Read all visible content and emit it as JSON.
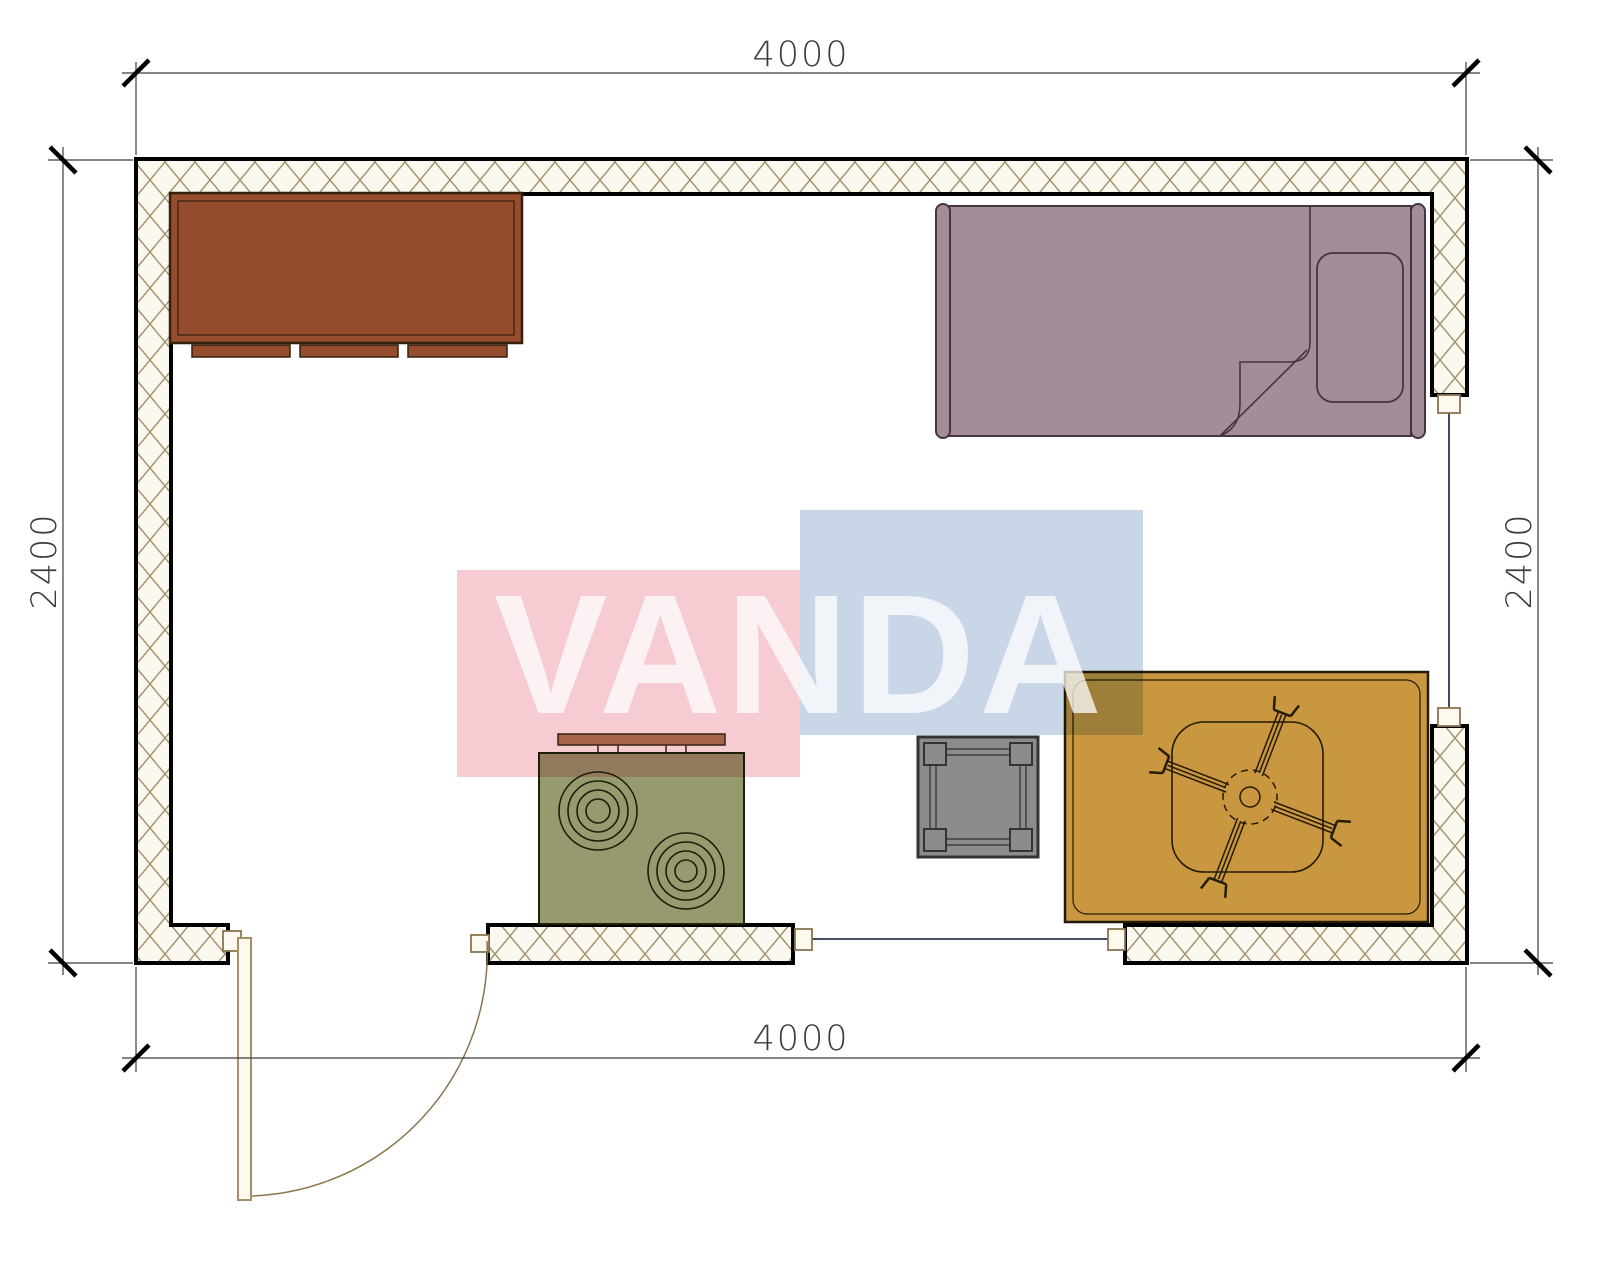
{
  "document": {
    "type": "room floor plan drawing",
    "room_width_mm": "4000",
    "room_depth_mm": "2400"
  },
  "dimensions": {
    "top": "4000",
    "bottom": "4000",
    "left": "2400",
    "right": "2400"
  },
  "watermark": {
    "text": "VANDA",
    "pink_color": "#f6ccd2",
    "blue_color": "#c8d6e8",
    "text_color": "#ffffff"
  },
  "walls": {
    "hatch_background": "#fbf8f0",
    "hatch_line": "#a2906c",
    "outline": "#000000"
  },
  "furniture": {
    "cabinet": {
      "color": "#964d2e"
    },
    "bed": {
      "color": "#a28d99"
    },
    "stove": {
      "color": "#97996f"
    },
    "side_table": {
      "color": "#8c8c8c"
    },
    "rug": {
      "color": "#c9973f"
    },
    "door": {
      "color": "#fdf9ee"
    }
  }
}
